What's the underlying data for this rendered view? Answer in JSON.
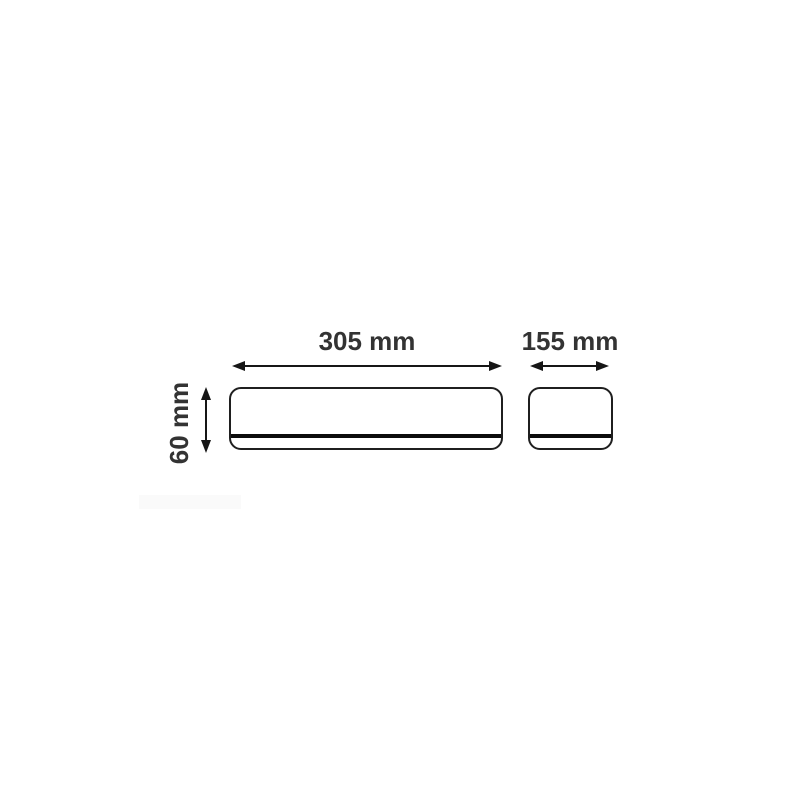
{
  "diagram": {
    "front_view": {
      "width_label": "305 mm",
      "width_mm": 305,
      "height_label": "60 mm",
      "height_mm": 60
    },
    "side_view": {
      "width_label": "155 mm",
      "width_mm": 155
    }
  },
  "colors": {
    "background": "#ffffff",
    "outline": "#1f1f1f",
    "dimension_line": "#161616",
    "divider_line": "#0c0c0c",
    "label_text": "#333333"
  }
}
